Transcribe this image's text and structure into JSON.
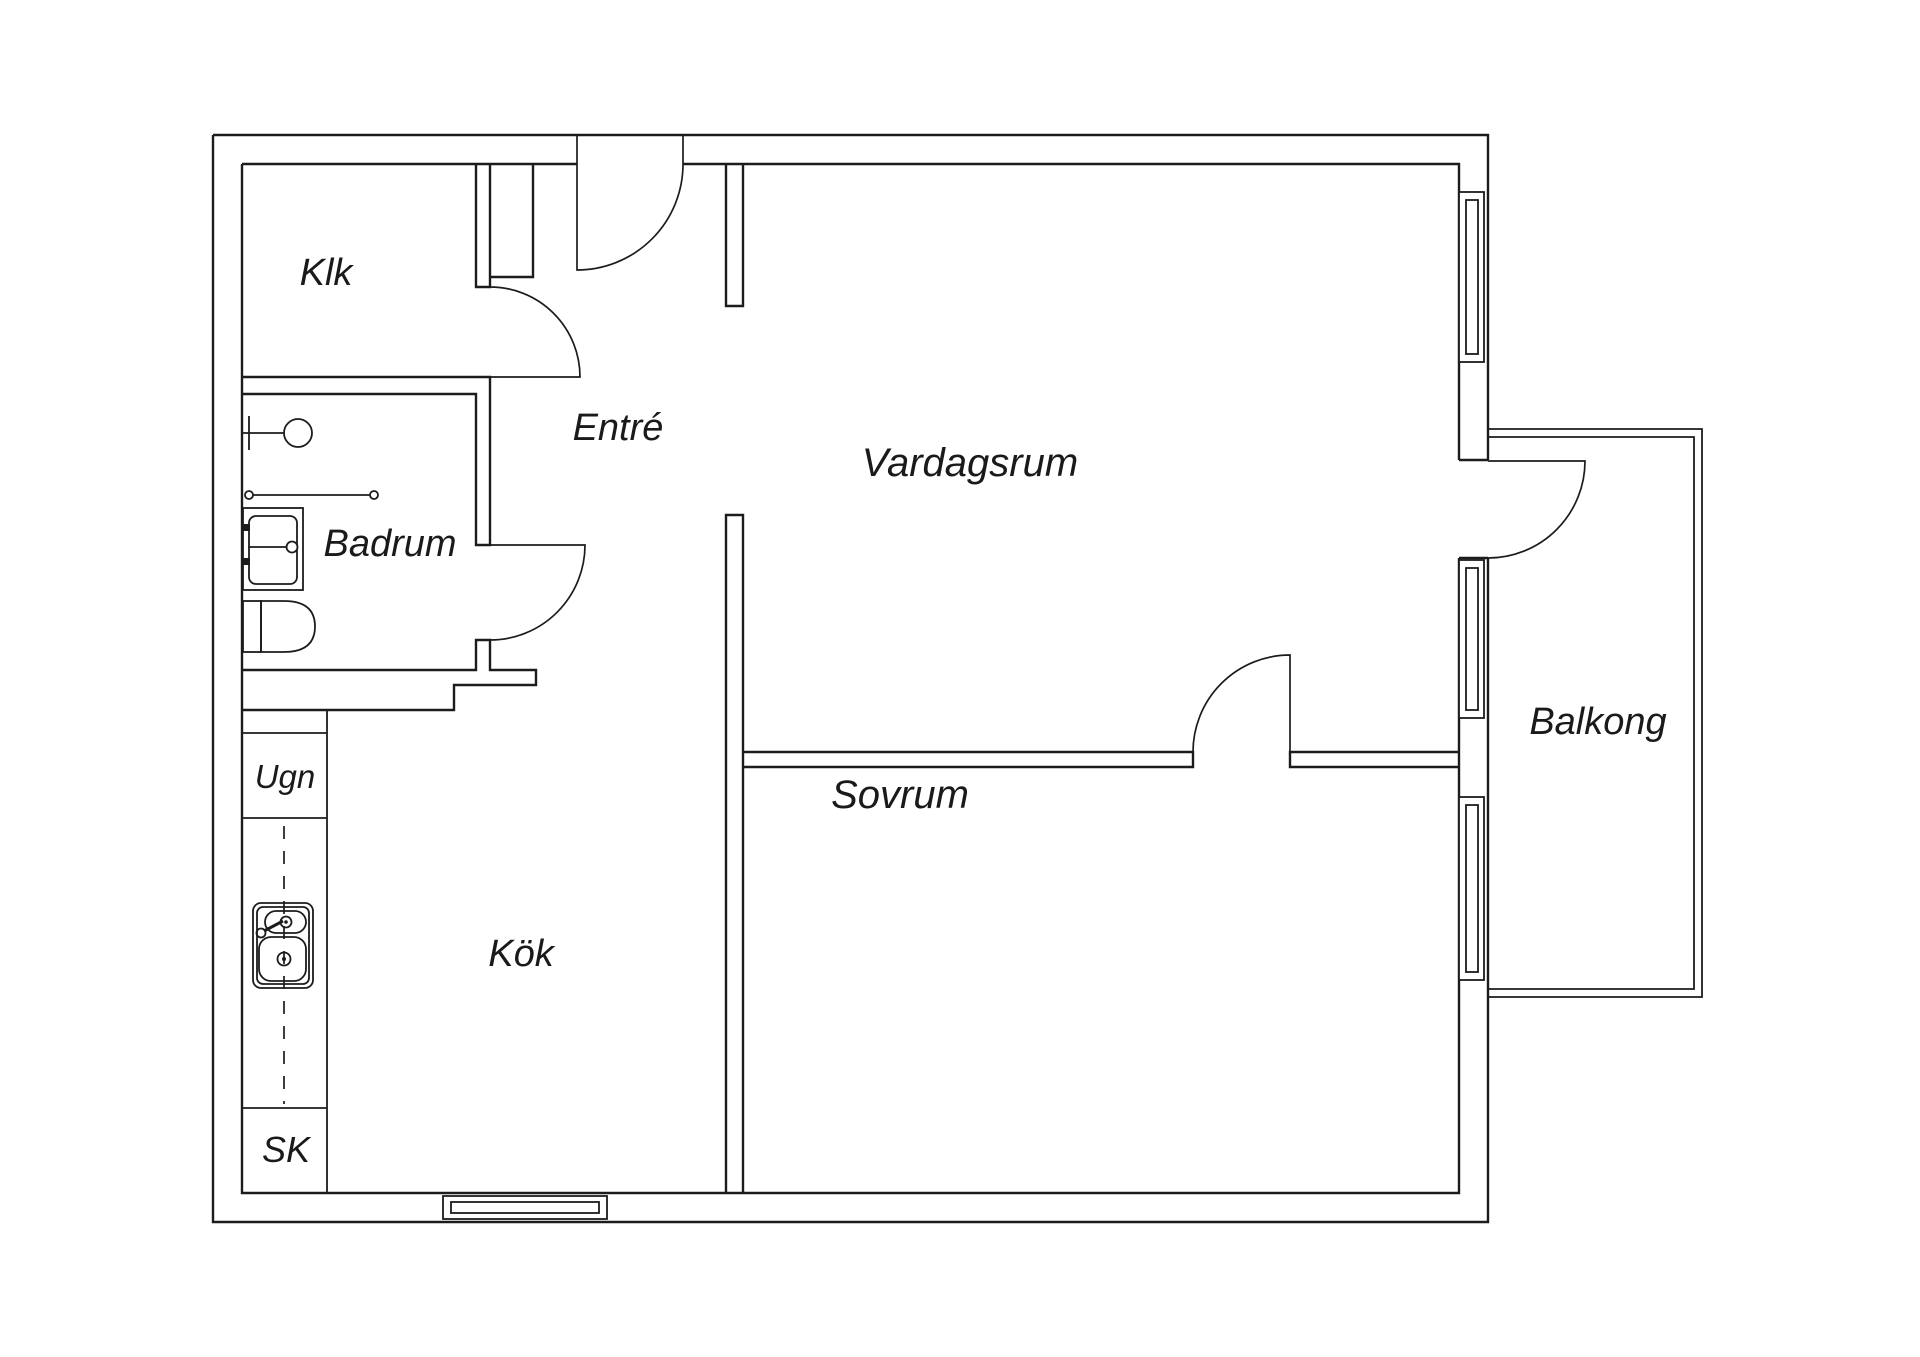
{
  "plan": {
    "background": "#ffffff",
    "line_color": "#1c1c1c",
    "labels": {
      "klk": "Klk",
      "entre": "Entré",
      "vardagsrum": "Vardagsrum",
      "badrum": "Badrum",
      "ugn": "Ugn",
      "kok": "Kök",
      "sk": "SK",
      "sovrum": "Sovrum",
      "balkong": "Balkong"
    }
  }
}
